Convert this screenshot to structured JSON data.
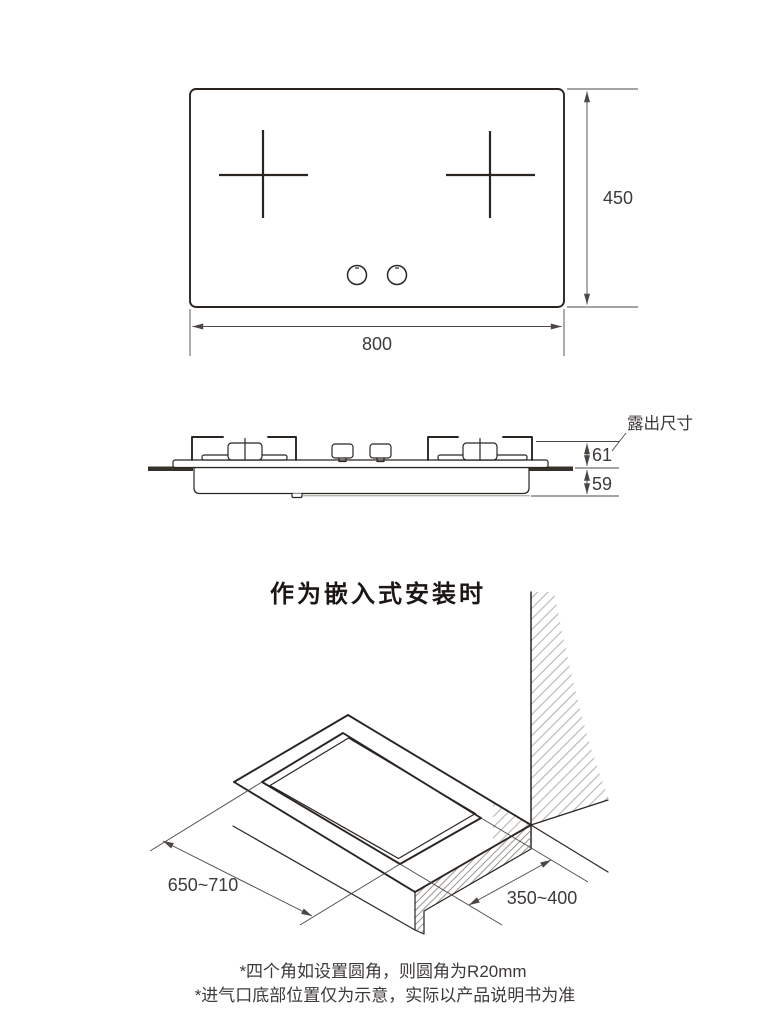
{
  "top_view": {
    "width": "800",
    "height": "450"
  },
  "side_view": {
    "label_exposed": "露出尺寸",
    "dim_above_counter": "61",
    "dim_below_counter": "59"
  },
  "embedded_view": {
    "title": "作为嵌入式安装时",
    "dim_cutout_length": "650~710",
    "dim_cutout_depth": "350~400"
  },
  "footnotes": {
    "note1": "*四个角如设置圆角，则圆角为R20mm",
    "note2": "*进气口底部位置仅为示意，实际以产品说明书为准"
  },
  "colors": {
    "line": "#2b2522",
    "dim_line": "#4c4743",
    "text": "#3e3a39",
    "hatch": "#a8a49f"
  }
}
